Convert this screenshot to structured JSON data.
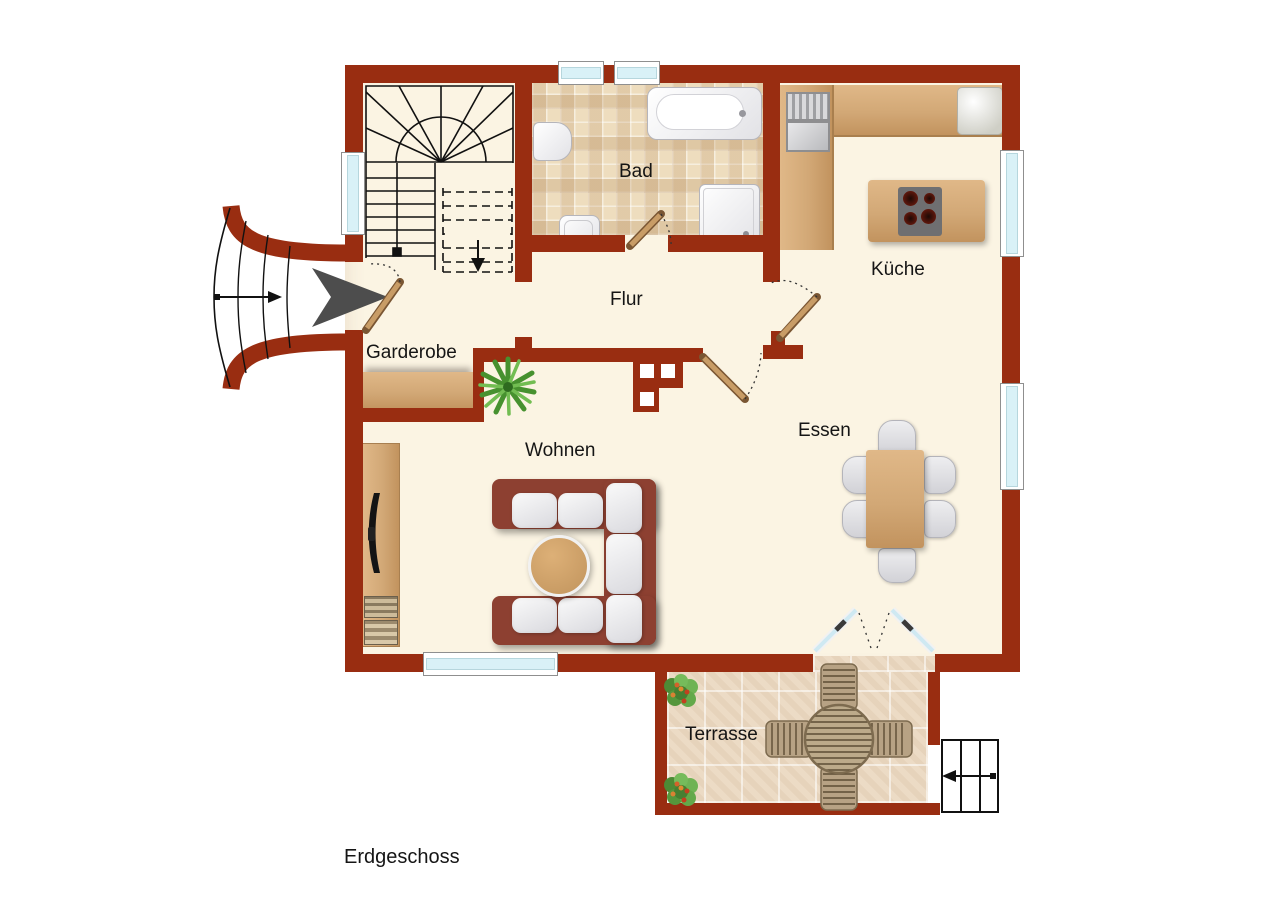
{
  "plan": {
    "floor_label": "Erdgeschoss",
    "rooms": {
      "bad": {
        "label": "Bad"
      },
      "kueche": {
        "label": "Küche"
      },
      "flur": {
        "label": "Flur"
      },
      "garderobe": {
        "label": "Garderobe"
      },
      "wohnen": {
        "label": "Wohnen"
      },
      "essen": {
        "label": "Essen"
      },
      "terrasse": {
        "label": "Terrasse"
      }
    },
    "colors": {
      "wall": "#992d11",
      "floor": "#fbf4e3",
      "bath_tile": "#eeddbe",
      "terrace_tile": "#ecdbc5",
      "wood": "#d2a876",
      "window_glass": "#d9f1f7",
      "entry_arrow": "#4d4d4d"
    },
    "furniture": [
      "winder-staircase",
      "bathtub",
      "toilet",
      "washbasin",
      "shower",
      "kitchen-counter",
      "kitchen-sink",
      "cooktop-island",
      "refrigerator",
      "wardrobe",
      "potted-plant",
      "tv-sideboard",
      "tv",
      "corner-sofa",
      "coffee-table",
      "dining-table",
      "dining-chairs",
      "terrace-table",
      "terrace-chairs",
      "shrubs",
      "entry-steps",
      "terrace-steps"
    ]
  }
}
